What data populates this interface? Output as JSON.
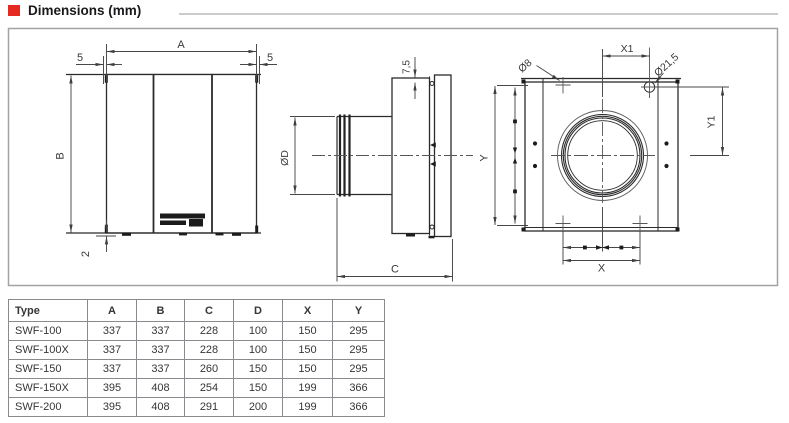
{
  "title": {
    "text": "Dimensions (mm)",
    "bullet_color": "#e62a22"
  },
  "drawing": {
    "labels": {
      "a": "A",
      "b": "B",
      "five_left": "5",
      "five_right": "5",
      "two": "2",
      "dia_d": "ØD",
      "seven_five": "7,5",
      "c": "C",
      "y": "Y",
      "x": "X",
      "x1": "X1",
      "y1": "Y1",
      "dia_8": "Ø8",
      "dia_21_5": "Ø21,5"
    }
  },
  "table": {
    "headers": [
      "Type",
      "A",
      "B",
      "C",
      "D",
      "X",
      "Y"
    ],
    "rows": [
      [
        "SWF-100",
        "337",
        "337",
        "228",
        "100",
        "150",
        "295"
      ],
      [
        "SWF-100X",
        "337",
        "337",
        "228",
        "100",
        "150",
        "295"
      ],
      [
        "SWF-150",
        "337",
        "337",
        "260",
        "150",
        "150",
        "295"
      ],
      [
        "SWF-150X",
        "395",
        "408",
        "254",
        "150",
        "199",
        "366"
      ],
      [
        "SWF-200",
        "395",
        "408",
        "291",
        "200",
        "199",
        "366"
      ]
    ]
  }
}
